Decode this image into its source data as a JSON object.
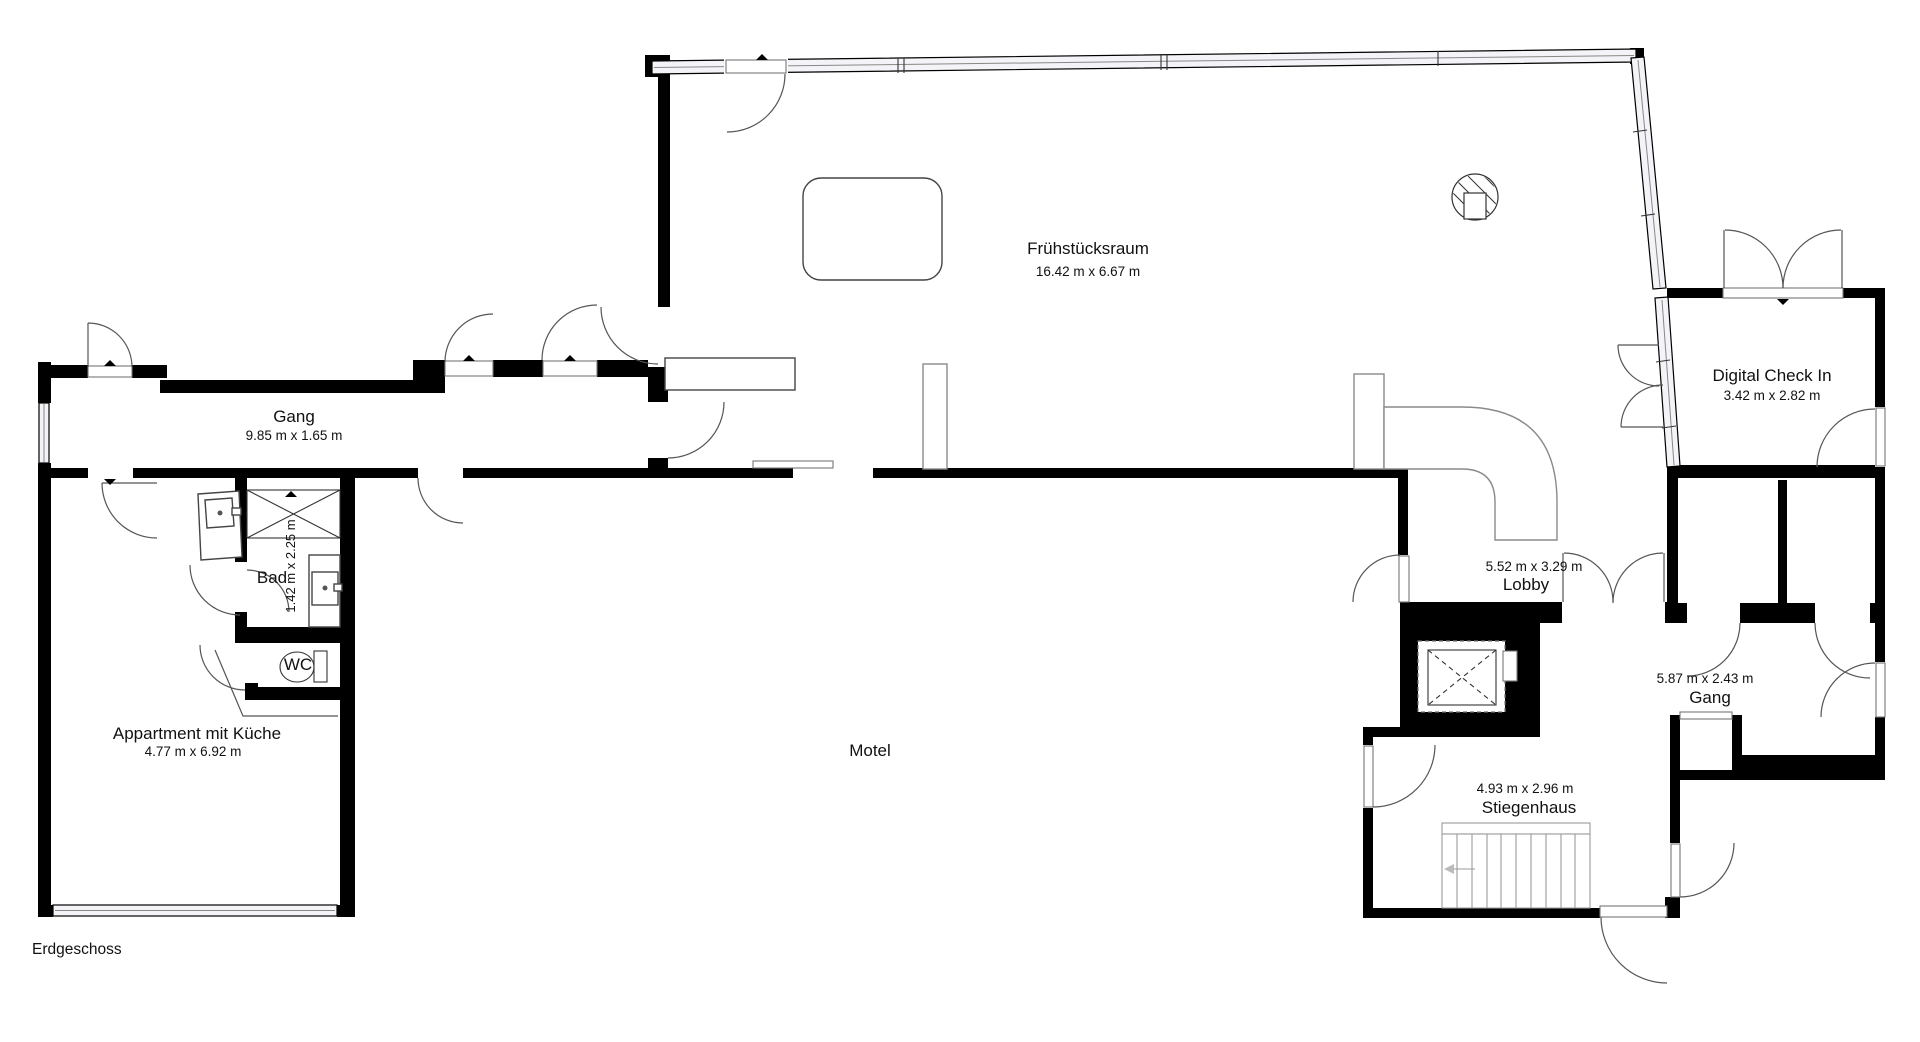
{
  "title": {
    "floor_label": "Erdgeschoss",
    "building_label": "Motel"
  },
  "rooms": {
    "breakfast_room": {
      "name": "Frühstücksraum",
      "dims": "16.42 m x 6.67 m"
    },
    "corridor_west": {
      "name": "Gang",
      "dims": "9.85 m x 1.65 m"
    },
    "bathroom": {
      "name": "Bad",
      "dims": "1.42 m x 2.25 m"
    },
    "wc": {
      "name": "WC"
    },
    "apartment": {
      "name": "Appartment mit Küche",
      "dims": "4.77 m x 6.92 m"
    },
    "digital_check_in": {
      "name": "Digital Check In",
      "dims": "3.42 m x 2.82 m"
    },
    "lobby": {
      "name": "Lobby",
      "dims": "5.52 m x 3.29 m"
    },
    "corridor_east": {
      "name": "Gang",
      "dims": "5.87 m x 2.43 m"
    },
    "staircase": {
      "name": "Stiegenhaus",
      "dims": "4.93 m x 2.96 m"
    }
  },
  "colors": {
    "wall": "#000000",
    "background": "#ffffff",
    "fixture": "#444444",
    "window_fill": "#f4f4f8",
    "label": "#111111"
  }
}
